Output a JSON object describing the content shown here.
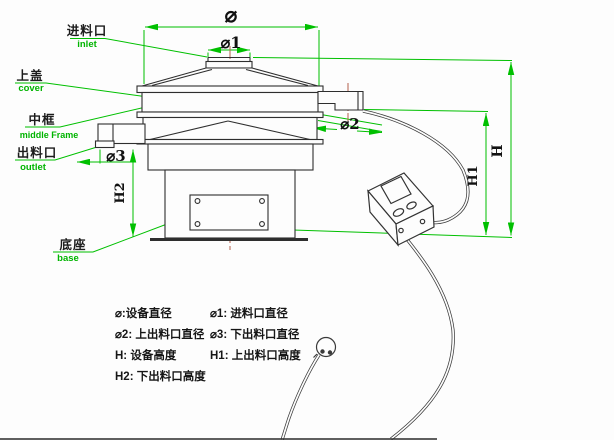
{
  "drawing": {
    "type": "vibrating-sieve-dimension-diagram"
  },
  "colors": {
    "dimension_green": "#00c000",
    "centerline_red": "#b4604b",
    "drawing_line": "#2e2e2e",
    "background": "#fdfdfd"
  },
  "part_labels": {
    "inlet": {
      "zh": "进料口",
      "en": "inlet"
    },
    "cover": {
      "zh": "上盖",
      "en": "cover"
    },
    "middle_frame": {
      "zh": "中框",
      "en": "middle Frame"
    },
    "outlet": {
      "zh": "出料口",
      "en": "outlet"
    },
    "base": {
      "zh": "底座",
      "en": "base"
    }
  },
  "dimension_labels": {
    "phi": "⌀",
    "phi1": "⌀1",
    "phi2": "⌀2",
    "phi3": "⌀3",
    "h": "H",
    "h1": "H1",
    "h2": "H2"
  },
  "legend": {
    "items": [
      "⌀:设备直径",
      "⌀1: 进料口直径",
      "⌀2: 上出料口直径",
      "⌀3: 下出料口直径",
      "H: 设备高度",
      "H1: 上出料口高度",
      "H2: 下出料口高度"
    ]
  }
}
